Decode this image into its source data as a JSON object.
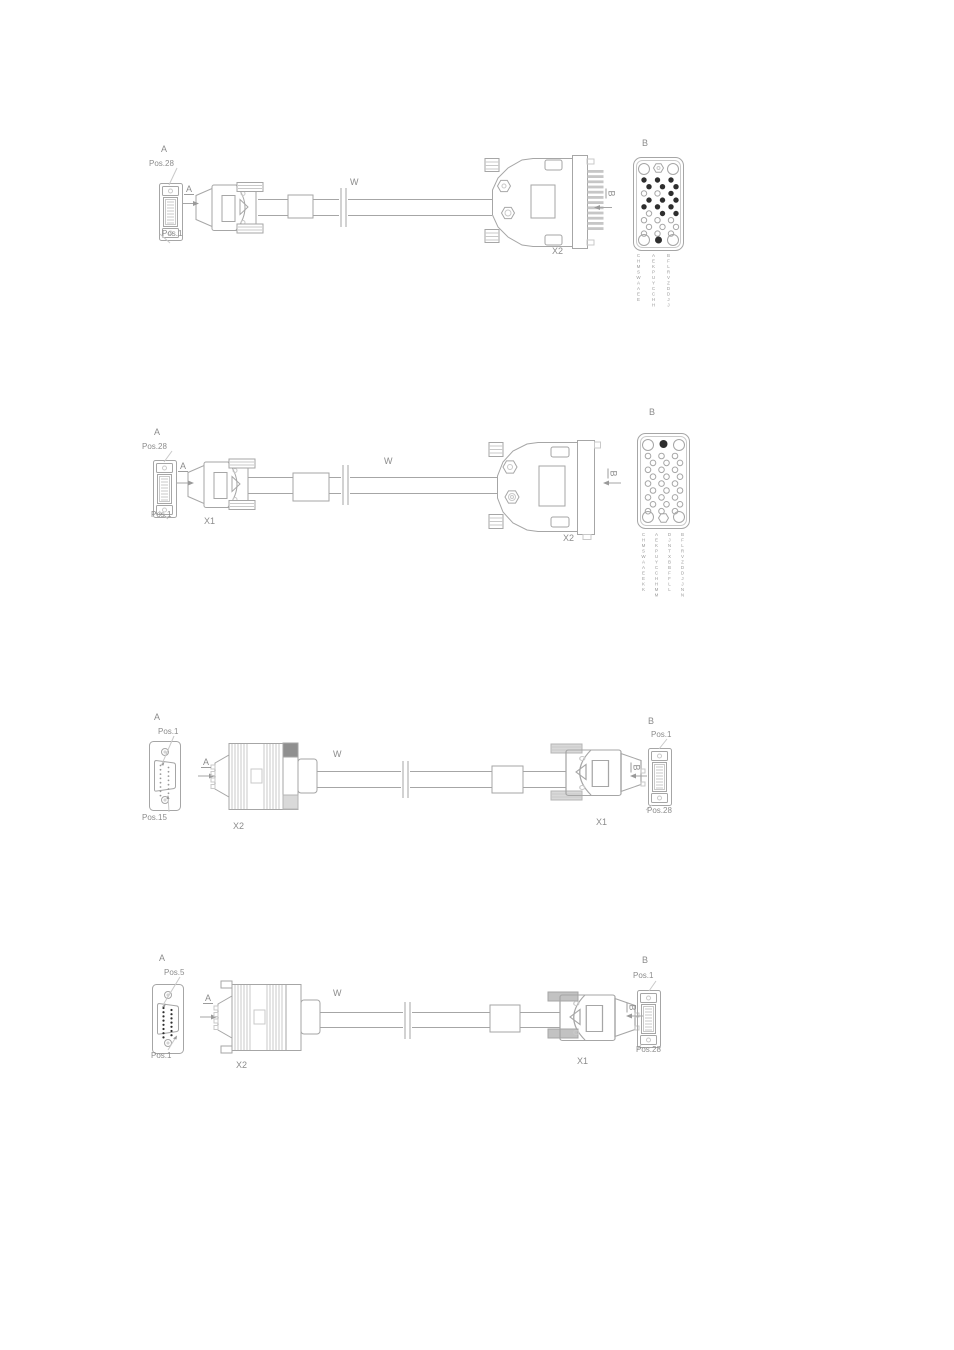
{
  "page": {
    "background": "#ffffff",
    "line_color": "#a6a6a6",
    "text_color": "#8c8c8c",
    "pin_fill_color": "#2e2e2e"
  },
  "diagrams": [
    {
      "name": "cable-assembly-1",
      "view_a": {
        "title": "A",
        "pos_top": "Pos.28",
        "pos_bottom": "Pos.1"
      },
      "section_a": "A",
      "cable_label": "W",
      "connector_x2": "X2",
      "section_b": "B",
      "view_b": {
        "title": "B",
        "pin_pattern": [
          "fff",
          "fff",
          "oof",
          "fff",
          "fff",
          "off",
          "ooo",
          "ooo",
          "ooo"
        ],
        "pin_columns": [
          "CHMSWAAEE",
          "AEKPUYCCHH",
          "BFLRVZDDJJ"
        ]
      }
    },
    {
      "name": "cable-assembly-2",
      "view_a": {
        "title": "A",
        "pos_top": "Pos.28",
        "pos_bottom": "Pos.1"
      },
      "connector_x1": "X1",
      "section_a": "A",
      "cable_label": "W",
      "connector_x2": "X2",
      "section_b": "B",
      "view_b": {
        "title": "B",
        "pin_pattern": [
          "ooo",
          "ooo",
          "ooo",
          "ooo",
          "ooo",
          "ooo",
          "ooo",
          "ooo",
          "ooo"
        ],
        "pin_columns": [
          "CHMSWAAEEKK",
          "AEKPUYCCHHMM",
          "DJNTXBBFFLL",
          "BFLRVZDDJJNN"
        ]
      }
    },
    {
      "name": "cable-assembly-3",
      "view_a": {
        "title": "A",
        "pos_top": "Pos.1",
        "pos_bottom": "Pos.15"
      },
      "connector_x2": "X2",
      "section_a": "A",
      "cable_label": "W",
      "connector_x1": "X1",
      "section_b": "B",
      "view_b": {
        "title": "B",
        "pos_top": "Pos.1",
        "pos_bottom": "Pos.28"
      }
    },
    {
      "name": "cable-assembly-4",
      "view_a": {
        "title": "A",
        "pos_top": "Pos.5",
        "pos_bottom": "Pos.1"
      },
      "connector_x2": "X2",
      "section_a": "A",
      "cable_label": "W",
      "connector_x1": "X1",
      "section_b": "B",
      "view_b": {
        "title": "B",
        "pos_top": "Pos.1",
        "pos_bottom": "Pos.28"
      }
    }
  ]
}
